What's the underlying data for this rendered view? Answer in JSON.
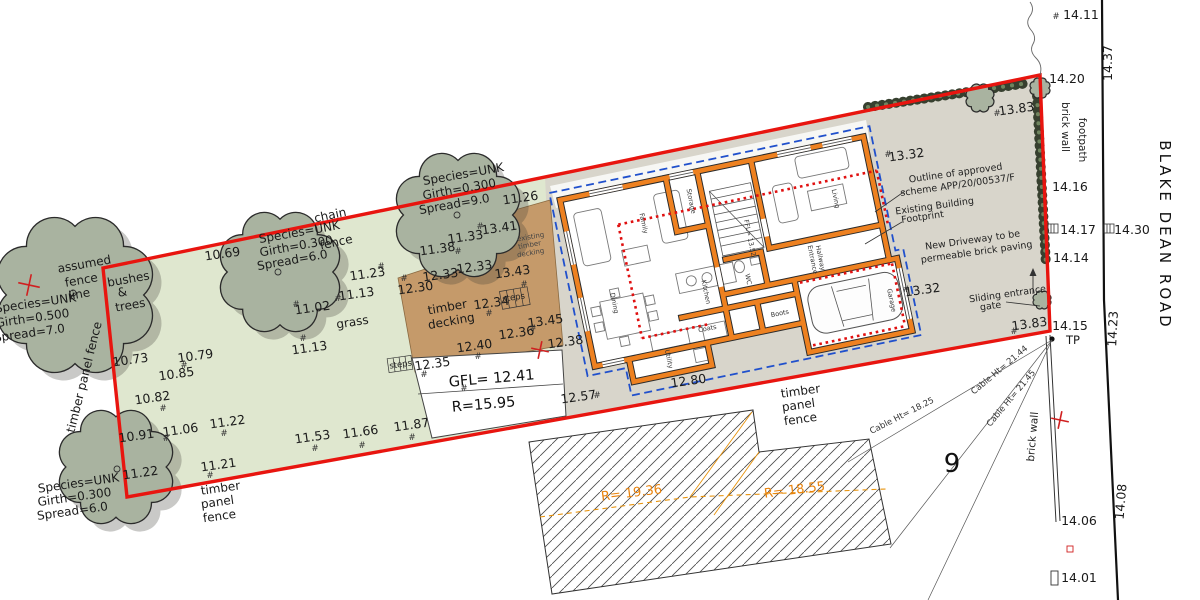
{
  "misc": {
    "hash": "#",
    "plot_number": "9",
    "tp_label": "TP"
  },
  "road": {
    "name": "BLAKE DEAN ROAD"
  },
  "gfl_box": {
    "line1": "GFL= 12.41",
    "line2": "R=15.95"
  },
  "radii": {
    "r1": "R= 19.36",
    "r2": "R= 18.55"
  },
  "cables": {
    "c1": "Cable Ht= 18.25",
    "c2": "Cable Ht= 21.44",
    "c3": "Cable Ht= 21.45"
  },
  "trees": [
    {
      "species": "Species=UNK",
      "girth": "Girth=0.500",
      "spread": "Spread=7.0"
    },
    {
      "species": "Species=UNK",
      "girth": "Girth=0.300",
      "spread": "Spread=6.0"
    },
    {
      "species": "Species=UNK",
      "girth": "Girth=0.300",
      "spread": "Spread=9.0"
    },
    {
      "species": "Species=UNK",
      "girth": "Girth=0.300",
      "spread": "Spread=6.0"
    }
  ],
  "labels": {
    "assumed1": "assumed",
    "assumed2": "fence",
    "assumed3": "line",
    "bushes1": "bushes",
    "bushes2": "&",
    "bushes3": "trees",
    "chain": "chain",
    "chain_fence": "fence",
    "grass": "grass",
    "tpf_left": "timber panel fence",
    "tpf1": "timber",
    "tpf2": "panel",
    "tpf3": "fence",
    "deck1": "timber",
    "deck2": "decking",
    "exdeck1": "existing",
    "exdeck2": "timber",
    "exdeck3": "decking",
    "steps": "steps",
    "brick_wall": "brick wall",
    "footpath": "footpath"
  },
  "annotations": {
    "approved1": "Outline of approved",
    "approved2": "scheme APP/20/00537/F",
    "existing1": "Existing Building",
    "existing2": "Footprint",
    "driveway1": "New Driveway to be",
    "driveway2": "permeable brick paving",
    "gate1": "Sliding entrance",
    "gate2": "gate"
  },
  "rooms": {
    "family": "Family",
    "dining": "Dining",
    "kitchen": "Kitchen",
    "storage": "Storage",
    "living": "Living",
    "hall1": "Entrance",
    "hall2": "Hallway",
    "wc": "WC",
    "utility": "Utility",
    "boots": "Boots",
    "coats": "Coats",
    "garage": "Garage",
    "ffl": "FFL= 13.52"
  },
  "spots": [
    "10.69",
    "11.23",
    "11.13",
    "11.02",
    "11.13",
    "10.79",
    "10.85",
    "10.73",
    "10.82",
    "10.91",
    "11.06",
    "11.22",
    "11.22",
    "11.21",
    "11.53",
    "11.66",
    "11.87",
    "11.26",
    "11.33",
    "13.41",
    "11.38",
    "12.33",
    "12.33",
    "12.30",
    "13.43",
    "12.34",
    "13.45",
    "12.36",
    "12.40",
    "12.38",
    "12.35",
    "12.57",
    "12.80",
    "13.32",
    "13.32",
    "13.83",
    "13.83",
    "14.20",
    "14.16",
    "14.17",
    "14.30",
    "14.14",
    "14.15",
    "14.11",
    "14.37",
    "14.23",
    "14.08",
    "14.06",
    "14.01"
  ]
}
